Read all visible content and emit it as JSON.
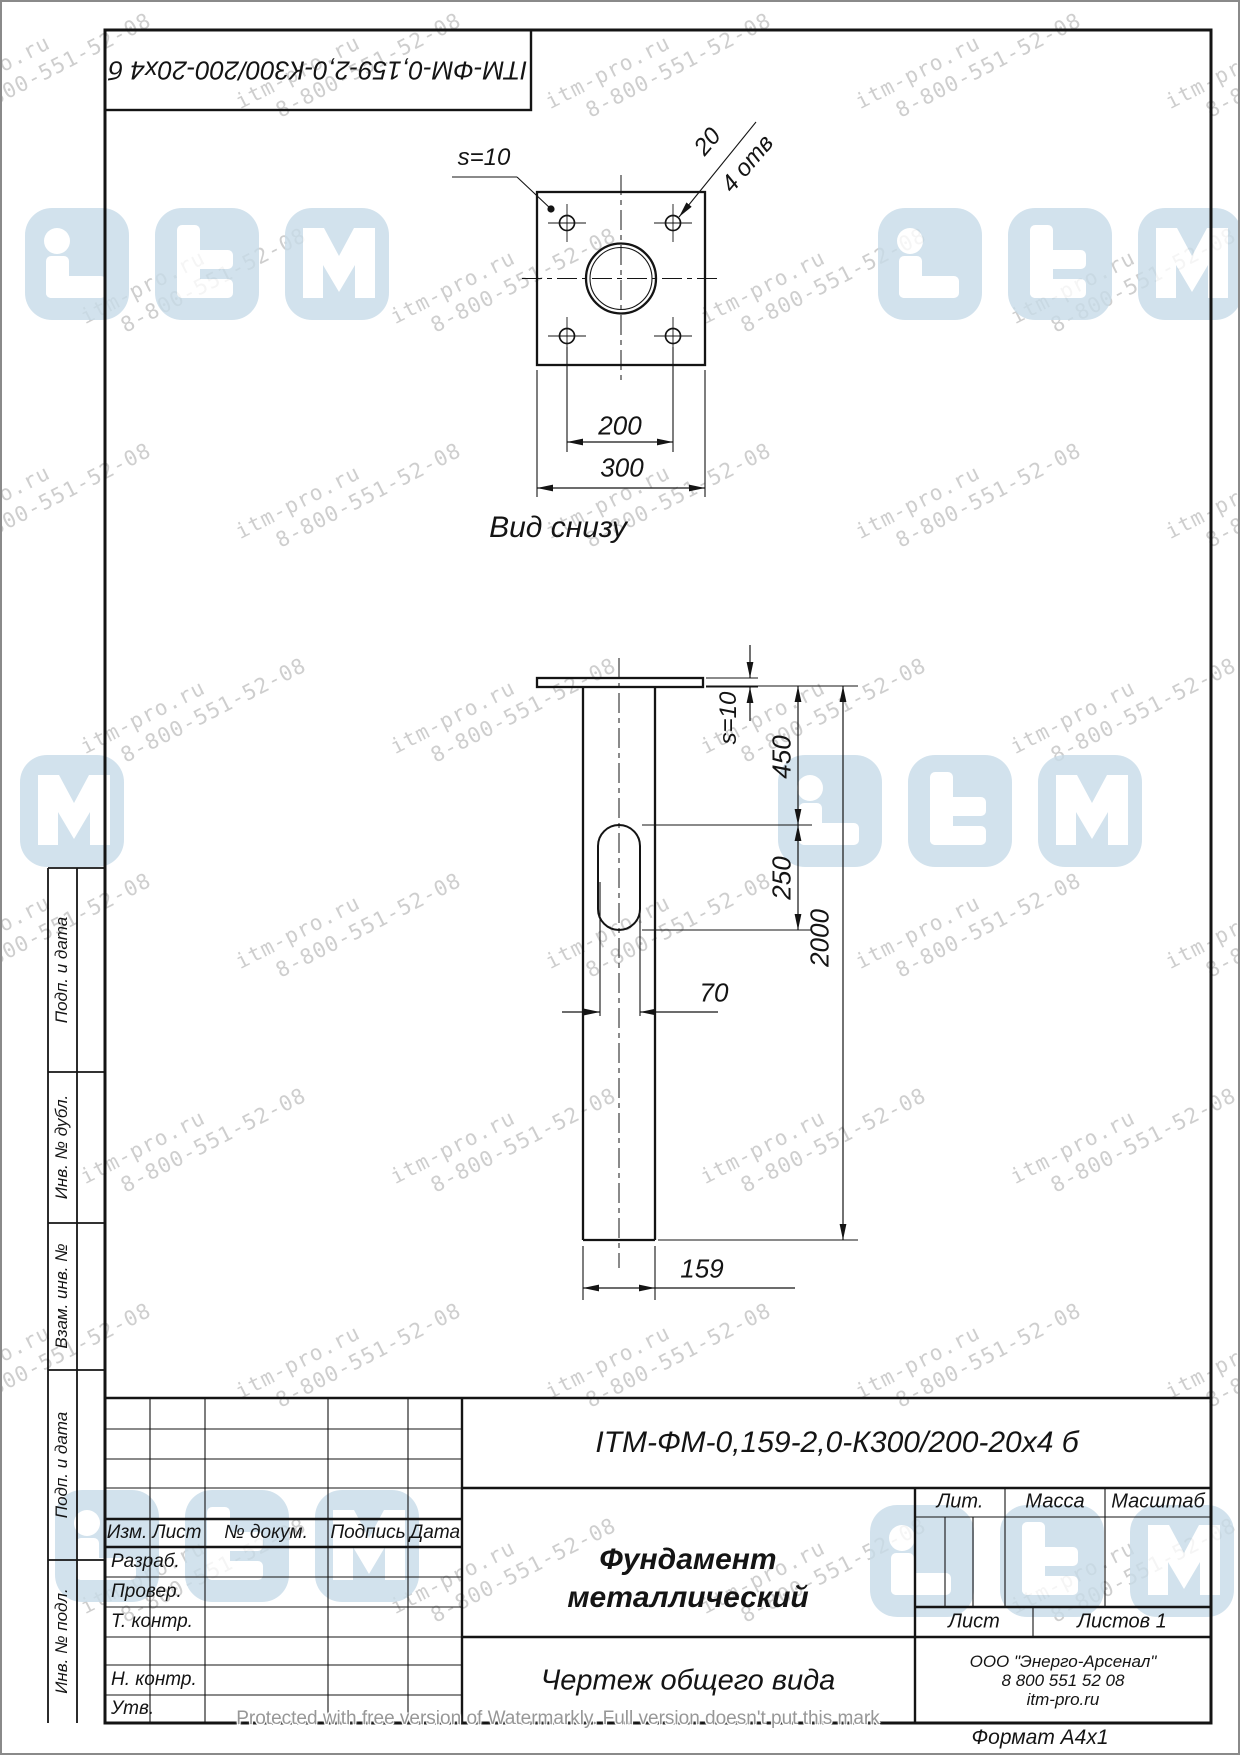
{
  "page": {
    "format_label": "Формат  А4х1",
    "watermark_notice": "Protected with free version of Watermarkly. Full version doesn't put this mark"
  },
  "watermark": {
    "line1": "itm-pro.ru",
    "line2": "8-800-551-52-08",
    "color": "#c6c6c6",
    "logo_color": "#c8dce9",
    "rows": 8,
    "cols": 5,
    "step_x": 310,
    "step_y": 215,
    "x0": -80,
    "y0": 35,
    "row_offset": 155
  },
  "drawing": {
    "top_designation": "ITM-ФМ-0,159-2,0-К300/200-20x4 б",
    "bottom_view": {
      "label": "Вид снизу",
      "thickness_label": "s=10",
      "holes_dia": "20",
      "holes_note": "4 отв",
      "dim_200": "200",
      "dim_300": "300"
    },
    "side_view": {
      "thickness_label": "s=10",
      "dim_450": "450",
      "dim_250": "250",
      "dim_2000": "2000",
      "dim_70": "70",
      "dim_159": "159"
    }
  },
  "title_block": {
    "designation": "ITM-ФМ-0,159-2,0-К300/200-20x4 б",
    "title_line1": "Фундамент",
    "title_line2": "металлический",
    "doc_type": "Чертеж общего вида",
    "headers": {
      "izm": "Изм.",
      "list": "Лист",
      "doc_num": "№ докум.",
      "signature": "Подпись",
      "date": "Дата",
      "lit": "Лит.",
      "mass": "Масса",
      "scale": "Масштаб",
      "sheet": "Лист",
      "sheets": "Листов 1"
    },
    "rows": {
      "razrab": "Разраб.",
      "prover": "Провер.",
      "t_kontr": "Т. контр.",
      "n_kontr": "Н. контр.",
      "utv": "Утв."
    },
    "company": {
      "name": "ООО \"Энерго-Арсенал\"",
      "phone": "8 800 551 52 08",
      "site": "itm-pro.ru"
    }
  },
  "margin_labels": {
    "l1": "Подп. и дата",
    "l2": "Инв. № дубл.",
    "l3": "Взам. инв. №",
    "l4": "Подп. и дата",
    "l5": "Инв. № подл."
  }
}
